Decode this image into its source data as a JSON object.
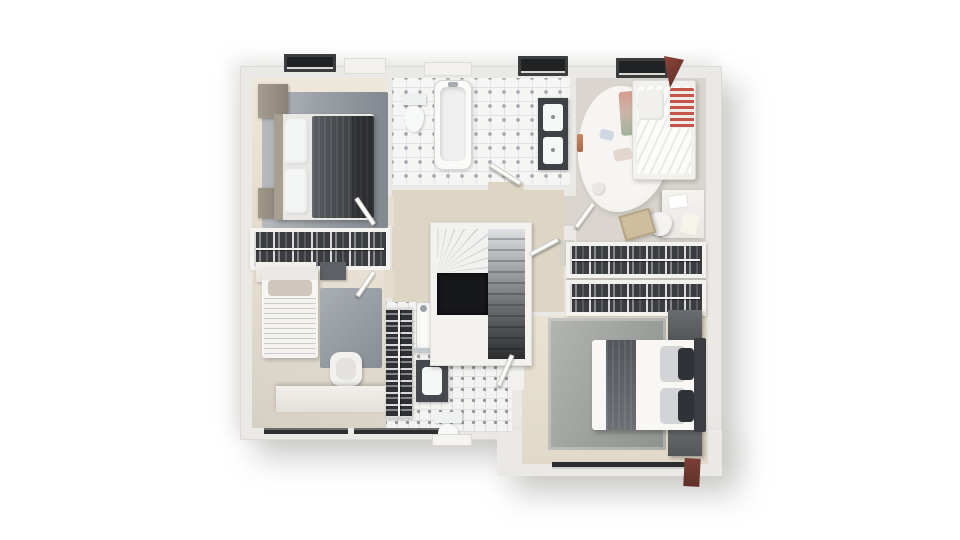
{
  "image": {
    "kind": "3d-floor-plan-render",
    "background": "#ffffff",
    "palette": {
      "wall": "#ebe9e6",
      "floor_beige": "#e9e1d2",
      "floor_wood_gray": "#dad6cf",
      "rug_gray": "#9aa0a6",
      "dark_furniture": "#3e4145",
      "tile_white": "#f5f5f3",
      "stair_void": "#17181a",
      "accent_red": "#c4554a",
      "dormer_dark": "#212223",
      "roof_red": "#7a4038"
    }
  },
  "layers": [
    {
      "name": "plan-body-main",
      "x": 240,
      "y": 66,
      "w": 482,
      "h": 374,
      "bg": "#ebe9e6",
      "br": "2px",
      "sh": "16px 18px 30px rgba(130,128,122,.40), -8px -6px 18px rgba(150,148,142,.22), inset 0 0 0 1px #dcdad6"
    },
    {
      "name": "plan-body-extension",
      "x": 497,
      "y": 430,
      "w": 225,
      "h": 46,
      "bg": "#ebe9e6",
      "sh": "16px 18px 30px rgba(130,128,122,.40)"
    },
    {
      "name": "bedroom-topleft-floor",
      "x": 252,
      "y": 78,
      "w": 134,
      "h": 150,
      "bg": "linear-gradient(180deg,#efe8da,#e3dccb)"
    },
    {
      "name": "bathroom-top-floor",
      "x": 392,
      "y": 78,
      "w": 178,
      "h": 108,
      "cls": "tile"
    },
    {
      "name": "kids-room-floor",
      "x": 576,
      "y": 78,
      "w": 130,
      "h": 166,
      "bg": "#dad6cf",
      "cls": "wood-v"
    },
    {
      "name": "closet-left-frame",
      "x": 250,
      "y": 228,
      "w": 140,
      "h": 42,
      "bg": "#f4f3f0",
      "sh": "0 1px 2px rgba(0,0,0,.15)"
    },
    {
      "name": "bedroom-bottomleft-floor",
      "x": 252,
      "y": 270,
      "w": 134,
      "h": 158,
      "bg": "linear-gradient(200deg,#e9e2d4,#d6d0c4)"
    },
    {
      "name": "hallway-floor",
      "x": 392,
      "y": 190,
      "w": 172,
      "h": 122,
      "bg": "#ded6c5",
      "cls": "wood-v"
    },
    {
      "name": "dressing-floor",
      "x": 566,
      "y": 248,
      "w": 140,
      "h": 64,
      "bg": "#d6d3cd"
    },
    {
      "name": "master-bedroom-floor",
      "x": 522,
      "y": 316,
      "w": 186,
      "h": 148,
      "bg": "linear-gradient(180deg,#eae3d4,#e0d9c9)"
    },
    {
      "name": "shower-room-floor",
      "x": 386,
      "y": 302,
      "w": 126,
      "h": 130,
      "cls": "tile2"
    },
    {
      "name": "doorway-bedroom-topleft",
      "x": 384,
      "y": 196,
      "w": 10,
      "h": 30,
      "bg": "#e7dfd0"
    },
    {
      "name": "doorway-bedroom-bottomleft",
      "x": 384,
      "y": 270,
      "w": 10,
      "h": 28,
      "bg": "#e3dccd"
    },
    {
      "name": "doorway-bathroom-top",
      "x": 488,
      "y": 182,
      "w": 36,
      "h": 10,
      "bg": "#ded6c5"
    },
    {
      "name": "doorway-kids-room",
      "x": 564,
      "y": 196,
      "w": 14,
      "h": 30,
      "bg": "#d9d5ce"
    },
    {
      "name": "doorway-master-suite",
      "x": 560,
      "y": 240,
      "w": 14,
      "h": 26,
      "bg": "#d6d3cd"
    },
    {
      "name": "doorway-shower-room",
      "x": 510,
      "y": 350,
      "w": 14,
      "h": 40,
      "bg": "#f2f1ee"
    },
    {
      "name": "bedroom-topleft-rug",
      "x": 262,
      "y": 92,
      "w": 126,
      "h": 136,
      "br": "2px",
      "bg": "linear-gradient(90deg,#b7babd 0%,#9aa0a6 45%,#82888f 100%)"
    },
    {
      "name": "wardrobe",
      "x": 258,
      "y": 84,
      "w": 30,
      "h": 34,
      "bg": "linear-gradient(90deg,#a59d92,#8b8378)",
      "sh": "1px 1px 3px rgba(0,0,0,.3)"
    },
    {
      "name": "nightstand",
      "x": 258,
      "y": 188,
      "w": 28,
      "h": 30,
      "bg": "linear-gradient(90deg,#a09889,#877f72)",
      "sh": "1px 1px 3px rgba(0,0,0,.3)"
    },
    {
      "name": "double-bed-dark-base",
      "x": 274,
      "y": 114,
      "w": 100,
      "h": 106,
      "bg": "#e9e7e3",
      "br": "3px",
      "sh": "2px 2px 4px rgba(0,0,0,.25)"
    },
    {
      "name": "double-bed-dark-headboard",
      "x": 274,
      "y": 114,
      "w": 9,
      "h": 106,
      "bg": "#a89f93"
    },
    {
      "name": "double-bed-dark-pillow-1",
      "x": 285,
      "y": 119,
      "w": 24,
      "h": 46,
      "bg": "#f4f5f5",
      "br": "5px",
      "sh": "inset -2px -2px 3px rgba(0,0,0,.12)"
    },
    {
      "name": "double-bed-dark-pillow-2",
      "x": 285,
      "y": 169,
      "w": 24,
      "h": 46,
      "bg": "#f4f5f5",
      "br": "5px",
      "sh": "inset -2px -2px 3px rgba(0,0,0,.12)"
    },
    {
      "name": "double-bed-dark-duvet",
      "x": 312,
      "y": 116,
      "w": 62,
      "h": 102,
      "bg": "linear-gradient(90deg,#5a5e62,#3e4145 60%,#34373b)",
      "br": "2px",
      "cls": "fabric"
    },
    {
      "name": "double-bed-dark-foot-throw",
      "x": 352,
      "y": 116,
      "w": 22,
      "h": 102,
      "bg": "rgba(22,24,27,.35)"
    },
    {
      "name": "closet-left-clothes",
      "x": 254,
      "y": 232,
      "w": 132,
      "h": 34,
      "cls": "clothes-h"
    },
    {
      "name": "dresser-white",
      "x": 256,
      "y": 262,
      "w": 60,
      "h": 20,
      "bg": "linear-gradient(#f3f1ed,#e6e3dd)",
      "sh": "1px 1px 3px rgba(0,0,0,.25)"
    },
    {
      "name": "dresser-gray",
      "x": 320,
      "y": 262,
      "w": 26,
      "h": 18,
      "bg": "#5d6064",
      "sh": "1px 1px 2px rgba(0,0,0,.3)"
    },
    {
      "name": "single-bed-base",
      "x": 262,
      "y": 268,
      "w": 56,
      "h": 90,
      "bg": "#f6f5f2",
      "br": "3px",
      "sh": "2px 2px 4px rgba(0,0,0,.22)"
    },
    {
      "name": "single-bed-headboard",
      "x": 262,
      "y": 268,
      "w": 56,
      "h": 12,
      "bg": "#eae8e4"
    },
    {
      "name": "single-bed-pillow",
      "x": 268,
      "y": 280,
      "w": 44,
      "h": 16,
      "bg": "#cfc7bd",
      "br": "4px"
    },
    {
      "name": "single-bed-blanket",
      "x": 264,
      "y": 298,
      "w": 52,
      "h": 58,
      "cls": "stripes-h"
    },
    {
      "name": "bedroom-bottomleft-rug",
      "x": 320,
      "y": 288,
      "w": 62,
      "h": 80,
      "br": "2px",
      "bg": "linear-gradient(135deg,#a9aeb3,#878d94)"
    },
    {
      "name": "armchair",
      "x": 330,
      "y": 352,
      "w": 32,
      "h": 34,
      "bg": "#f2f1ee",
      "br": "10px",
      "sh": "1px 2px 3px rgba(0,0,0,.25)"
    },
    {
      "name": "armchair-seat",
      "x": 336,
      "y": 358,
      "w": 20,
      "h": 22,
      "bg": "#e4e2de",
      "br": "8px"
    },
    {
      "name": "desk-long",
      "x": 276,
      "y": 386,
      "w": 110,
      "h": 26,
      "bg": "linear-gradient(#f2f0ec,#e3e0da)",
      "sh": "0 -2px 4px rgba(0,0,0,.18)"
    },
    {
      "name": "window-bottom-1",
      "x": 264,
      "y": 428,
      "w": 84,
      "h": 6,
      "bg": "#2d2e2f",
      "sh": "inset 0 2px 0 #6b6c6d"
    },
    {
      "name": "window-bottom-2",
      "x": 354,
      "y": 428,
      "w": 100,
      "h": 6,
      "bg": "#2d2e2f",
      "sh": "inset 0 2px 0 #6b6c6d"
    },
    {
      "name": "bathtub",
      "x": 434,
      "y": 80,
      "w": 38,
      "h": 90,
      "bg": "#fafaf8",
      "br": "9px",
      "bd": "1px solid #d6d5d2",
      "sh": "1px 1px 3px rgba(0,0,0,.18)"
    },
    {
      "name": "bathtub-basin",
      "x": 440,
      "y": 87,
      "w": 26,
      "h": 74,
      "bg": "#eff0ef",
      "br": "7px",
      "sh": "inset 1px 2px 4px rgba(0,0,0,.15)"
    },
    {
      "name": "bathtub-faucet",
      "x": 448,
      "y": 82,
      "w": 10,
      "h": 5,
      "bg": "#a7abaf",
      "br": "2px"
    },
    {
      "name": "toilet-top-tank",
      "x": 402,
      "y": 94,
      "w": 24,
      "h": 11,
      "bg": "#eff0f0",
      "sh": "1px 1px 2px rgba(0,0,0,.2)"
    },
    {
      "name": "toilet-top-bowl",
      "x": 404,
      "y": 106,
      "w": 20,
      "h": 26,
      "bg": "#f7f8f8",
      "br": "50% 50% 50% 50%/40% 40% 60% 60%",
      "sh": "1px 1px 2px rgba(0,0,0,.2)"
    },
    {
      "name": "vanity-double",
      "x": 538,
      "y": 98,
      "w": 30,
      "h": 72,
      "bg": "#3e4145",
      "sh": "1px 1px 3px rgba(0,0,0,.3)"
    },
    {
      "name": "vanity-sink-1",
      "x": 543,
      "y": 104,
      "w": 20,
      "h": 27,
      "bg": "#f5f6f6",
      "br": "3px"
    },
    {
      "name": "vanity-sink-2",
      "x": 543,
      "y": 137,
      "w": 20,
      "h": 27,
      "bg": "#f5f6f6",
      "br": "3px"
    },
    {
      "name": "sink-drain-1",
      "x": 551,
      "y": 115,
      "w": 4,
      "h": 4,
      "bg": "#8a8e92",
      "br": "50%"
    },
    {
      "name": "sink-drain-2",
      "x": 551,
      "y": 148,
      "w": 4,
      "h": 4,
      "bg": "#8a8e92",
      "br": "50%"
    },
    {
      "name": "kids-rug-fluffy",
      "x": 578,
      "y": 86,
      "w": 92,
      "h": 126,
      "bg": "radial-gradient(ellipse at 45% 40%,#f7f5f1 60%,#eceae4)",
      "br": "46% 54% 58% 42%/52% 48% 52% 48%",
      "sh": "2px 3px 6px rgba(0,0,0,.12)"
    },
    {
      "name": "kids-playmat",
      "x": 620,
      "y": 92,
      "w": 18,
      "h": 44,
      "bg": "linear-gradient(180deg,#d89a92,#c9b6a6 50%,#9fb39b)",
      "br": "3px",
      "tf": "rotate(-4deg)"
    },
    {
      "name": "kids-bed-frame",
      "x": 632,
      "y": 80,
      "w": 64,
      "h": 100,
      "bg": "#f2f1ee",
      "br": "3px",
      "bd": "1px solid #dddbd7",
      "sh": "2px 2px 5px rgba(0,0,0,.2)"
    },
    {
      "name": "kids-bed-duvet",
      "x": 637,
      "y": 86,
      "w": 54,
      "h": 88,
      "br": "2px",
      "cls": "stripes-diag"
    },
    {
      "name": "kids-red-blanket",
      "x": 670,
      "y": 88,
      "w": 24,
      "h": 40,
      "br": "2px",
      "cls": "stripes-red"
    },
    {
      "name": "kids-pillow",
      "x": 638,
      "y": 90,
      "w": 26,
      "h": 30,
      "bg": "#f1f0ec",
      "br": "5px",
      "sh": "inset -1px -1px 2px rgba(0,0,0,.1)"
    },
    {
      "name": "kids-toy-1",
      "x": 600,
      "y": 128,
      "w": 14,
      "h": 10,
      "bg": "#cfd8e2",
      "br": "3px",
      "tf": "rotate(15deg)"
    },
    {
      "name": "kids-toy-2",
      "x": 614,
      "y": 150,
      "w": 18,
      "h": 12,
      "bg": "#e3d5cf",
      "br": "3px",
      "tf": "rotate(-10deg)"
    },
    {
      "name": "kids-ball",
      "x": 592,
      "y": 182,
      "w": 12,
      "h": 12,
      "bg": "#e9e7e3",
      "br": "50%",
      "sh": "1px 1px 2px rgba(0,0,0,.2)"
    },
    {
      "name": "kids-desk",
      "x": 662,
      "y": 190,
      "w": 42,
      "h": 48,
      "bg": "linear-gradient(#f4f3f0,#e9e7e2)",
      "sh": "-2px 1px 4px rgba(0,0,0,.2)"
    },
    {
      "name": "kids-desk-paper-1",
      "x": 668,
      "y": 196,
      "w": 20,
      "h": 14,
      "bg": "#ffffff",
      "bd": "1px solid #e3e1db",
      "tf": "rotate(-8deg)"
    },
    {
      "name": "kids-desk-paper-2",
      "x": 682,
      "y": 212,
      "w": 16,
      "h": 20,
      "bg": "#f6f3ea",
      "tf": "rotate(12deg)"
    },
    {
      "name": "kids-chair",
      "x": 648,
      "y": 212,
      "w": 24,
      "h": 24,
      "bg": "#f4f3f1",
      "br": "50% 50% 50% 50%/45% 45% 55% 55%",
      "sh": "1px 2px 3px rgba(0,0,0,.25)"
    },
    {
      "name": "kids-toy-box",
      "x": 622,
      "y": 216,
      "w": 32,
      "h": 26,
      "bg": "#cebd9f",
      "bd": "2px solid #b6a484",
      "tf": "rotate(-16deg)",
      "sh": "2px 2px 3px rgba(0,0,0,.2)"
    },
    {
      "name": "towel-rail-copper",
      "x": 577,
      "y": 134,
      "w": 6,
      "h": 18,
      "bg": "linear-gradient(#c8875f,#a86a48)",
      "br": "2px"
    },
    {
      "name": "clothes-rack-1-frame",
      "x": 566,
      "y": 242,
      "w": 140,
      "h": 36,
      "bg": "#f3f2ef",
      "sh": "1px 1px 3px rgba(0,0,0,.2)"
    },
    {
      "name": "clothes-rack-1",
      "x": 570,
      "y": 246,
      "w": 132,
      "h": 28,
      "cls": "clothes-h"
    },
    {
      "name": "clothes-rack-2-frame",
      "x": 566,
      "y": 280,
      "w": 140,
      "h": 36,
      "bg": "#f3f2ef",
      "sh": "1px 1px 3px rgba(0,0,0,.2)"
    },
    {
      "name": "clothes-rack-2",
      "x": 570,
      "y": 284,
      "w": 132,
      "h": 28,
      "cls": "clothes-h"
    },
    {
      "name": "master-rug",
      "x": 548,
      "y": 318,
      "w": 118,
      "h": 132,
      "br": "2px",
      "bg": "linear-gradient(115deg,#b3b5b2,#9b9e9b 60%,#8f928f)",
      "sh": "inset 0 0 0 3px rgba(255,255,255,.25)"
    },
    {
      "name": "master-nightstand-1",
      "x": 668,
      "y": 310,
      "w": 34,
      "h": 30,
      "bg": "linear-gradient(#6a6d70,#54575a)",
      "sh": "2px 2px 4px rgba(0,0,0,.3)"
    },
    {
      "name": "master-nightstand-2",
      "x": 668,
      "y": 424,
      "w": 34,
      "h": 32,
      "bg": "linear-gradient(#6a6d70,#54575a)",
      "sh": "2px 2px 4px rgba(0,0,0,.3)"
    },
    {
      "name": "master-bed-base",
      "x": 592,
      "y": 340,
      "w": 110,
      "h": 90,
      "bg": "#f8f7f4",
      "br": "3px",
      "sh": "2px 3px 5px rgba(0,0,0,.25)"
    },
    {
      "name": "master-bed-throw",
      "x": 606,
      "y": 340,
      "w": 30,
      "h": 90,
      "bg": "linear-gradient(180deg,#53575b,#6c7074)",
      "cls": "fabric"
    },
    {
      "name": "master-pillow-1",
      "x": 660,
      "y": 346,
      "w": 26,
      "h": 36,
      "bg": "#d3d4d6",
      "br": "5px"
    },
    {
      "name": "master-pillow-2",
      "x": 660,
      "y": 388,
      "w": 26,
      "h": 36,
      "bg": "#d3d4d6",
      "br": "5px"
    },
    {
      "name": "master-pillow-dark-1",
      "x": 678,
      "y": 348,
      "w": 16,
      "h": 32,
      "bg": "#2f3236",
      "br": "4px"
    },
    {
      "name": "master-pillow-dark-2",
      "x": 678,
      "y": 390,
      "w": 16,
      "h": 32,
      "bg": "#2f3236",
      "br": "4px"
    },
    {
      "name": "master-headboard",
      "x": 694,
      "y": 338,
      "w": 12,
      "h": 94,
      "bg": "#3a3d41",
      "br": "2px"
    },
    {
      "name": "master-window",
      "x": 552,
      "y": 462,
      "w": 140,
      "h": 7,
      "bg": "#2c2d2e",
      "sh": "inset 0 -2px 0 #cfcecb"
    },
    {
      "name": "exterior-door-brown",
      "x": 684,
      "y": 458,
      "w": 16,
      "h": 28,
      "bg": "linear-gradient(#7a4038,#5f3029)",
      "tf": "rotate(3deg)"
    },
    {
      "name": "linen-shelf-towels",
      "x": 386,
      "y": 308,
      "w": 26,
      "h": 110,
      "cls": "clothes-v",
      "sh": "1px 1px 3px rgba(0,0,0,.3)"
    },
    {
      "name": "shower-tray",
      "x": 416,
      "y": 302,
      "w": 62,
      "h": 48,
      "bg": "#fafaf8",
      "bd": "1px solid #d3d2cf",
      "sh": "inset 0 0 6px rgba(0,0,0,.08)"
    },
    {
      "name": "shower-glass",
      "x": 414,
      "y": 348,
      "w": 66,
      "h": 4,
      "bg": "rgba(185,195,200,.8)",
      "sh": "0 1px 2px rgba(0,0,0,.25)"
    },
    {
      "name": "shower-drain",
      "x": 456,
      "y": 320,
      "w": 14,
      "h": 14,
      "bg": "#eef0f0",
      "br": "50%",
      "bd": "2px solid #b9bdc0"
    },
    {
      "name": "shower-head",
      "x": 420,
      "y": 305,
      "w": 7,
      "h": 7,
      "bg": "#9aa0a4",
      "br": "50%"
    },
    {
      "name": "vanity-small",
      "x": 416,
      "y": 360,
      "w": 32,
      "h": 42,
      "bg": "#45484c",
      "sh": "1px 1px 3px rgba(0,0,0,.3)"
    },
    {
      "name": "vanity-small-basin",
      "x": 422,
      "y": 367,
      "w": 20,
      "h": 28,
      "bg": "#f5f6f6",
      "br": "4px"
    },
    {
      "name": "toilet-bottom-tank",
      "x": 434,
      "y": 412,
      "w": 28,
      "h": 11,
      "bg": "#eff0f0",
      "sh": "1px 1px 2px rgba(0,0,0,.2)"
    },
    {
      "name": "toilet-bottom-bowl",
      "x": 438,
      "y": 424,
      "w": 20,
      "h": 20,
      "bg": "#f7f8f8",
      "br": "50%/45% 45% 55% 55%",
      "sh": "1px 1px 2px rgba(0,0,0,.2)"
    },
    {
      "name": "window-bay-bottom",
      "x": 432,
      "y": 434,
      "w": 40,
      "h": 12,
      "bg": "#f4f3f0",
      "bd": "1px solid #dbd9d5"
    },
    {
      "name": "stair-surround",
      "x": 430,
      "y": 222,
      "w": 102,
      "h": 144,
      "bg": "#f3f2ef",
      "sh": "1px 2px 4px rgba(0,0,0,.25), inset 0 0 0 1px #e0deda"
    },
    {
      "name": "stair-winders",
      "x": 437,
      "y": 229,
      "w": 51,
      "h": 44,
      "cls": "winder"
    },
    {
      "name": "stair-flight",
      "x": 488,
      "y": 229,
      "w": 37,
      "h": 130,
      "cls": "treads"
    },
    {
      "name": "stair-void",
      "x": 437,
      "y": 273,
      "w": 51,
      "h": 42,
      "bg": "#17181a",
      "sh": "inset 0 0 6px rgba(0,0,0,.9)"
    },
    {
      "name": "door-leaf-bedroom-topleft",
      "x": 372,
      "y": 194,
      "w": 5,
      "h": 32,
      "cls": "door",
      "tf": "rotate(-34deg)",
      "to": "bottom left"
    },
    {
      "name": "door-leaf-bedroom-bottomleft",
      "x": 372,
      "y": 270,
      "w": 5,
      "h": 30,
      "cls": "door",
      "tf": "rotate(34deg)",
      "to": "top left"
    },
    {
      "name": "door-leaf-bathroom-top",
      "x": 490,
      "y": 162,
      "w": 36,
      "h": 5,
      "cls": "door",
      "tf": "rotate(32deg)",
      "to": "left center"
    },
    {
      "name": "door-leaf-kids-room",
      "x": 574,
      "y": 196,
      "w": 5,
      "h": 30,
      "cls": "door",
      "tf": "rotate(36deg)",
      "to": "bottom left"
    },
    {
      "name": "door-leaf-master-suite",
      "x": 530,
      "y": 252,
      "w": 32,
      "h": 5,
      "cls": "door",
      "tf": "rotate(-28deg)",
      "to": "left center"
    },
    {
      "name": "door-leaf-shower-room",
      "x": 510,
      "y": 354,
      "w": 5,
      "h": 34,
      "cls": "door",
      "tf": "rotate(24deg)",
      "to": "top left"
    },
    {
      "name": "dormer-window-1",
      "x": 284,
      "y": 54,
      "w": 52,
      "h": 18,
      "cls": "dormer"
    },
    {
      "name": "roof-bump-1",
      "x": 344,
      "y": 58,
      "w": 42,
      "h": 16,
      "bg": "#f2f1ee",
      "bd": "1px solid #dedcd8"
    },
    {
      "name": "roof-bump-2",
      "x": 424,
      "y": 62,
      "w": 48,
      "h": 14,
      "bg": "#f2f1ee",
      "bd": "1px solid #dedcd8"
    },
    {
      "name": "dormer-window-2",
      "x": 518,
      "y": 56,
      "w": 50,
      "h": 20,
      "cls": "dormer"
    },
    {
      "name": "dormer-window-3",
      "x": 616,
      "y": 58,
      "w": 52,
      "h": 20,
      "cls": "dormer"
    },
    {
      "name": "dormer-roof-red",
      "x": 664,
      "y": 56,
      "w": 20,
      "h": 32,
      "bg": "linear-gradient(135deg,#8a443b,#5e2d26)",
      "cp": "polygon(0 0,100% 12%,30% 100%)"
    }
  ]
}
